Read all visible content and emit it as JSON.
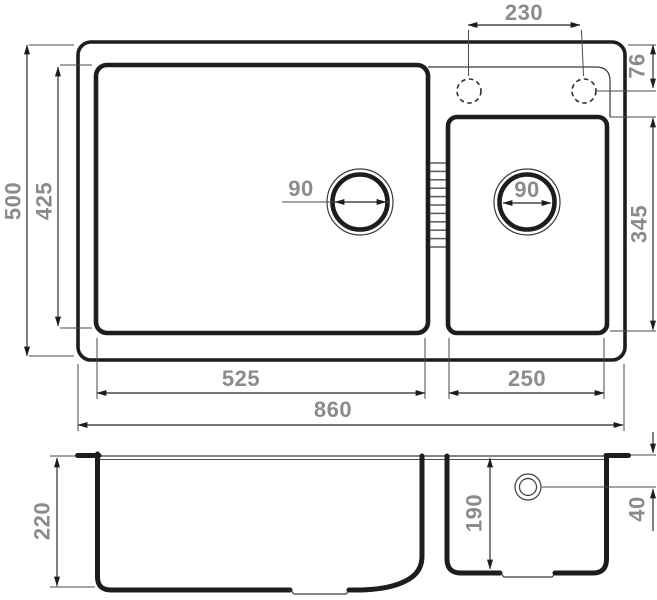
{
  "drawing": {
    "colors": {
      "line": "#1d1d1b",
      "dim_text": "#8b8b8d",
      "background": "#ffffff"
    },
    "dimensions": {
      "overall_width": "860",
      "overall_depth": "500",
      "bowls_depth": "425",
      "main_bowl_width": "525",
      "second_bowl_width": "250",
      "second_bowl_depth": "345",
      "tap_holes_spacing": "230",
      "tap_hole_inset": "76",
      "main_drain_diameter": "90",
      "second_drain_diameter": "90",
      "main_bowl_height": "220",
      "second_bowl_height": "190",
      "overflow_inset": "40"
    }
  }
}
